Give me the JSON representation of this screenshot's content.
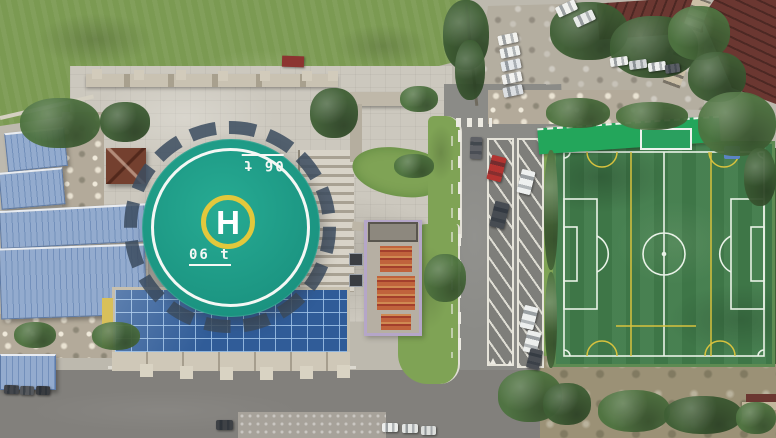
{
  "scene": {
    "description": "Aerial drone photo: campus with rooftop helipad over a glass atrium, plaza, blue-roof sheds, parking road and football pitch",
    "helipad": {
      "letter": "H",
      "weight_marking": "06 t"
    },
    "colors": {
      "base_pavement": "#bdb9ae",
      "plaza": "#ccc8be",
      "grass_field": "#7b9a52",
      "grass_dark": "#5e7f41",
      "helipad_deck": "#1fa189",
      "helipad_ring": "#f4f7f4",
      "helipad_circle": "#e2c83c",
      "helipad_text": "#ffffff",
      "skirt_tick": "#3c4d60",
      "glass_roof": "#305c98",
      "glass_grid": "#8fb0d8",
      "shed_blue": "#93abce",
      "shed_ridge": "#7390bb",
      "pitch_turf": "#417c4b",
      "pitch_line": "#e9f2e7",
      "pitch_yellow": "#d8c23e",
      "stand_roof": "#23a65b",
      "stand_wall": "#c3b94a",
      "road_asphalt": "#8b8b87",
      "road_dark": "#82807c",
      "road_line": "#eceae2",
      "gravel_lot": "#b4aea0",
      "tree_dark": "#3f5f35",
      "tree_mid": "#4e7340",
      "maroon_roof": "#6b3731",
      "gazebo_roof": "#74402f",
      "construction_orange": "#c0633c",
      "construction_tarp": "#b5a6c8",
      "rubble": "#b3aa9a",
      "sidewalk": "#a7a29a",
      "curb": "#dcd9d0",
      "lawn": "#7fa355",
      "stone": "#bfb8a9",
      "facade": "#cfc8b8",
      "dirt_scrub": "#9b9176"
    },
    "vehicles": [
      {
        "x": 498,
        "y": 34,
        "w": 20,
        "h": 10,
        "r": -12,
        "c": "#f2f2ee"
      },
      {
        "x": 500,
        "y": 47,
        "w": 20,
        "h": 10,
        "r": -12,
        "c": "#eef0ee"
      },
      {
        "x": 501,
        "y": 60,
        "w": 20,
        "h": 10,
        "r": -12,
        "c": "#e4e7ea"
      },
      {
        "x": 502,
        "y": 73,
        "w": 20,
        "h": 10,
        "r": -12,
        "c": "#f1f1ef"
      },
      {
        "x": 503,
        "y": 86,
        "w": 20,
        "h": 10,
        "r": -12,
        "c": "#dcdfe2"
      },
      {
        "x": 556,
        "y": 3,
        "w": 21,
        "h": 11,
        "r": -25,
        "c": "#f0f1ee"
      },
      {
        "x": 574,
        "y": 13,
        "w": 21,
        "h": 11,
        "r": -25,
        "c": "#e8eae8"
      },
      {
        "x": 610,
        "y": 57,
        "w": 18,
        "h": 9,
        "r": -8,
        "c": "#eff0ee"
      },
      {
        "x": 629,
        "y": 60,
        "w": 18,
        "h": 9,
        "r": -8,
        "c": "#d6d8da"
      },
      {
        "x": 648,
        "y": 62,
        "w": 18,
        "h": 9,
        "r": -8,
        "c": "#eef0ee"
      },
      {
        "x": 665,
        "y": 64,
        "w": 15,
        "h": 9,
        "r": -8,
        "c": "#5a5e64"
      },
      {
        "x": 489,
        "y": 156,
        "w": 15,
        "h": 25,
        "r": 14,
        "c": "#b23431"
      },
      {
        "x": 492,
        "y": 202,
        "w": 15,
        "h": 26,
        "r": 14,
        "c": "#474c52"
      },
      {
        "x": 519,
        "y": 170,
        "w": 14,
        "h": 24,
        "r": 14,
        "c": "#eef0ef"
      },
      {
        "x": 522,
        "y": 306,
        "w": 14,
        "h": 23,
        "r": 14,
        "c": "#edefee"
      },
      {
        "x": 525,
        "y": 331,
        "w": 14,
        "h": 22,
        "r": 14,
        "c": "#eceeec"
      },
      {
        "x": 528,
        "y": 349,
        "w": 13,
        "h": 20,
        "r": 14,
        "c": "#4a4e54"
      },
      {
        "x": 470,
        "y": 137,
        "w": 12,
        "h": 22,
        "r": 2,
        "c": "#5f6166"
      },
      {
        "x": 216,
        "y": 420,
        "w": 17,
        "h": 10,
        "r": 0,
        "c": "#3f4246"
      },
      {
        "x": 382,
        "y": 423,
        "w": 16,
        "h": 9,
        "r": 0,
        "c": "#eceeec"
      },
      {
        "x": 402,
        "y": 424,
        "w": 16,
        "h": 9,
        "r": 0,
        "c": "#e4e6e4"
      },
      {
        "x": 421,
        "y": 426,
        "w": 15,
        "h": 9,
        "r": 0,
        "c": "#dcdedc"
      },
      {
        "x": 4,
        "y": 385,
        "w": 15,
        "h": 9,
        "r": 2,
        "c": "#43464b"
      },
      {
        "x": 20,
        "y": 386,
        "w": 14,
        "h": 9,
        "r": 2,
        "c": "#55585c"
      },
      {
        "x": 36,
        "y": 386,
        "w": 14,
        "h": 9,
        "r": 2,
        "c": "#393c40"
      }
    ],
    "vegetation": [
      {
        "x": 20,
        "y": 98,
        "w": 80,
        "h": 50,
        "c": "tree_mid"
      },
      {
        "x": 100,
        "y": 102,
        "w": 50,
        "h": 40,
        "c": "tree_dark"
      },
      {
        "x": 310,
        "y": 88,
        "w": 48,
        "h": 50,
        "c": "tree_dark"
      },
      {
        "x": 394,
        "y": 154,
        "w": 40,
        "h": 24,
        "c": "tree_mid"
      },
      {
        "x": 424,
        "y": 254,
        "w": 42,
        "h": 48,
        "c": "tree_mid"
      },
      {
        "x": 400,
        "y": 86,
        "w": 38,
        "h": 26,
        "c": "tree_mid"
      },
      {
        "x": 443,
        "y": 0,
        "w": 46,
        "h": 70,
        "c": "tree_dark"
      },
      {
        "x": 455,
        "y": 40,
        "w": 30,
        "h": 60,
        "c": "tree_dark"
      },
      {
        "x": 550,
        "y": 2,
        "w": 78,
        "h": 58,
        "c": "tree_dark"
      },
      {
        "x": 610,
        "y": 16,
        "w": 88,
        "h": 62,
        "c": "tree_dark"
      },
      {
        "x": 668,
        "y": 6,
        "w": 62,
        "h": 54,
        "c": "tree_mid"
      },
      {
        "x": 688,
        "y": 52,
        "w": 58,
        "h": 50,
        "c": "tree_dark"
      },
      {
        "x": 698,
        "y": 92,
        "w": 78,
        "h": 64,
        "c": "tree_mid"
      },
      {
        "x": 744,
        "y": 148,
        "w": 32,
        "h": 58,
        "c": "tree_dark"
      },
      {
        "x": 546,
        "y": 98,
        "w": 64,
        "h": 30,
        "c": "tree_mid"
      },
      {
        "x": 616,
        "y": 102,
        "w": 72,
        "h": 28,
        "c": "tree_mid"
      },
      {
        "x": 498,
        "y": 370,
        "w": 64,
        "h": 52,
        "c": "tree_mid"
      },
      {
        "x": 543,
        "y": 383,
        "w": 48,
        "h": 42,
        "c": "tree_dark"
      },
      {
        "x": 598,
        "y": 390,
        "w": 72,
        "h": 42,
        "c": "tree_mid"
      },
      {
        "x": 664,
        "y": 396,
        "w": 78,
        "h": 38,
        "c": "tree_dark"
      },
      {
        "x": 736,
        "y": 402,
        "w": 40,
        "h": 32,
        "c": "tree_mid"
      },
      {
        "x": 92,
        "y": 322,
        "w": 48,
        "h": 28,
        "c": "tree_mid"
      },
      {
        "x": 14,
        "y": 322,
        "w": 42,
        "h": 26,
        "c": "tree_mid"
      },
      {
        "x": 544,
        "y": 150,
        "w": 14,
        "h": 120,
        "c": "tree_mid"
      },
      {
        "x": 545,
        "y": 272,
        "w": 12,
        "h": 96,
        "c": "tree_mid"
      }
    ]
  }
}
